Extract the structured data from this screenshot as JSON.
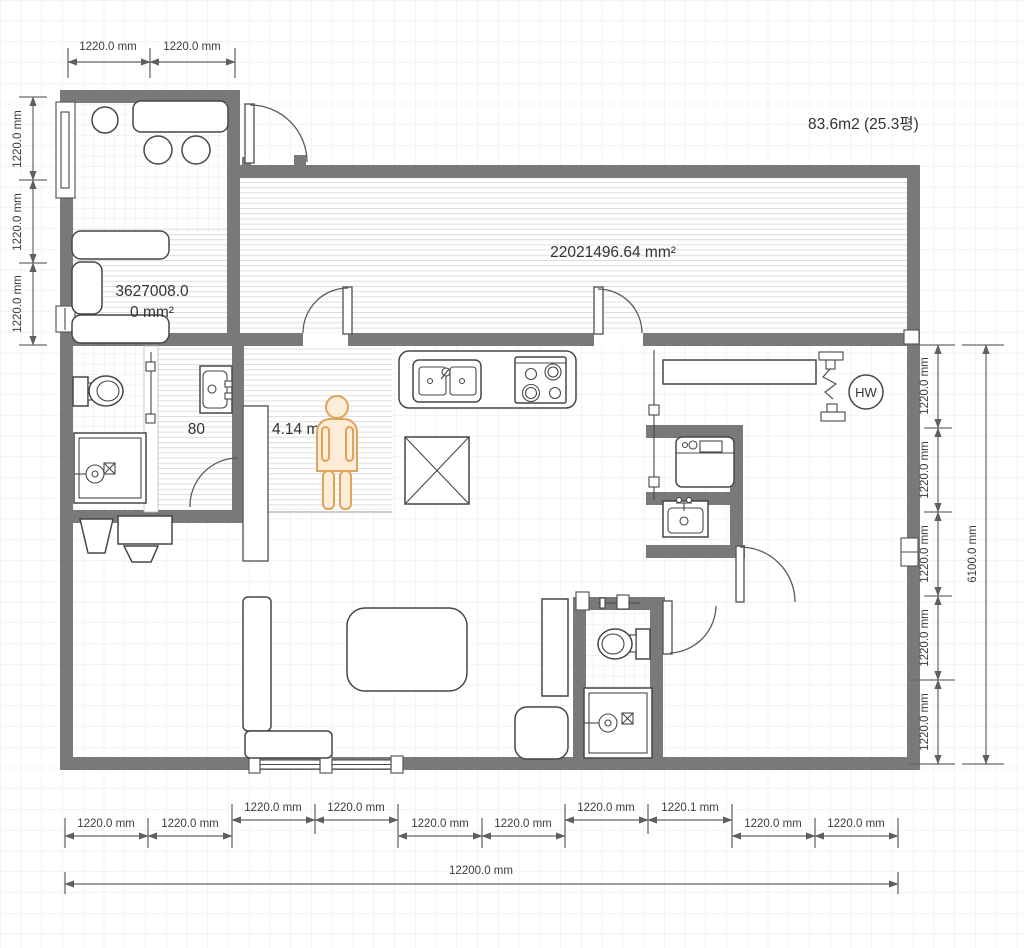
{
  "plan": {
    "area_total_label": "83.6m2 (25.3평)",
    "labels": {
      "great_room_area": "22021496.64 mm²",
      "dining_area_line1": "3627008.0",
      "dining_area_line2": "0 mm²",
      "hall_area_prefix": "80",
      "hall_area_suffix": "4.14 mm",
      "water_heater": "HW"
    },
    "dimensions": {
      "top": [
        "1220.0 mm",
        "1220.0 mm"
      ],
      "left": [
        "1220.0 mm",
        "1220.0 mm",
        "1220.0 mm"
      ],
      "right": [
        "1220.0 mm",
        "1220.0 mm",
        "1220.0 mm",
        "1220.0 mm",
        "1220.0 mm"
      ],
      "right_total": "6100.0 mm",
      "bottom_lower": [
        "1220.0 mm",
        "1220.0 mm",
        "1220.0 mm",
        "1220.0 mm",
        "1220.0 mm",
        "1220.0 mm"
      ],
      "bottom_upper": [
        "1220.0 mm",
        "1220.0 mm",
        "1220.0 mm",
        "1220.1 mm"
      ],
      "bottom_total": "12200.0 mm"
    },
    "colors": {
      "wall": "#797979",
      "dimension_line": "#666666",
      "person_stroke": "#e0a35c",
      "person_fill": "#fdecd7"
    }
  }
}
